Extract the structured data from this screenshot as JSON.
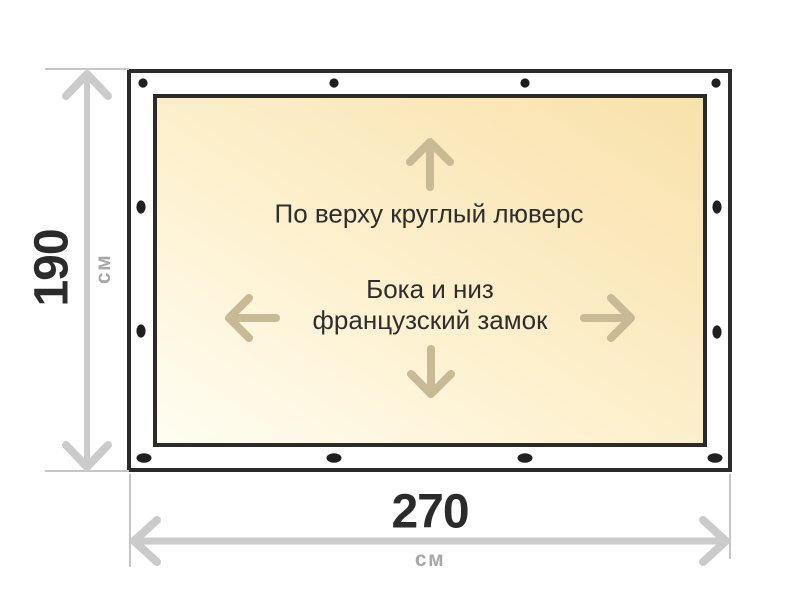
{
  "diagram": {
    "kind": "tarp-size-diagram",
    "dimensions": {
      "height": {
        "value": "190",
        "unit": "см"
      },
      "width": {
        "value": "270",
        "unit": "см"
      }
    },
    "notes": {
      "top_edge": "По верху круглый люверс",
      "sides_line1": "Бока и низ",
      "sides_line2": "французский замок"
    },
    "icons": {
      "up_arrow": "↑",
      "down_arrow": "↓",
      "left_arrow": "←",
      "right_arrow": "→"
    },
    "colors": {
      "outline": "#2b2b2b",
      "panel_gradient_start": "#fffdf2",
      "panel_gradient_end": "#f8e1ab",
      "arrow_accent": "#c9ba96",
      "dimension_line": "#cbcbcb",
      "extension_line": "#c6c6c6",
      "unit_label_gray": "#a8a8a8",
      "text_dark": "#2e2e2e",
      "grommet": "#1f1f1f"
    }
  }
}
